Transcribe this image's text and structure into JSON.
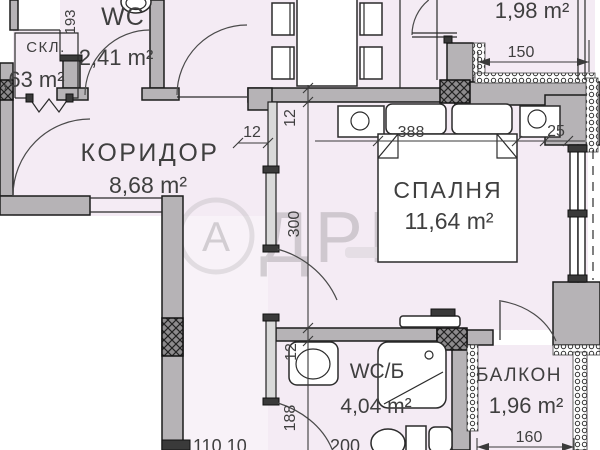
{
  "plan": {
    "rooms": {
      "storage": {
        "label": "СКЛ.",
        "area": "1,63 m²"
      },
      "wc_top": {
        "label": "WC",
        "area": "2,41 m²"
      },
      "corridor": {
        "label": "КОРИДОР",
        "area": "8,68 m²"
      },
      "bedroom": {
        "label": "СПАЛНЯ",
        "area": "11,64 m²"
      },
      "balcony_top": {
        "area": "1,98 m²"
      },
      "bathroom": {
        "label": "WC/Б",
        "area": "4,04 m²"
      },
      "balcony_bottom": {
        "label": "БАЛКОН",
        "area": "1,96 m²"
      }
    },
    "dimensions": {
      "wc_door": "193",
      "wall_thickness_h": "12",
      "wall_thickness_v": "12",
      "bedroom_depth": "300",
      "bedroom_width": "388",
      "nightstand_gap": "25",
      "balcony_top_width": "150",
      "balcony_bottom_width": "160",
      "bathroom_depth": "188",
      "bathroom_wall": "12",
      "bottom_left_chain": "110 10",
      "bottom_center_chain": "200"
    },
    "watermark": {
      "logo_letter": "А",
      "brand": "ДРЕС"
    },
    "colors": {
      "room_fill": "#f4ebf4",
      "wall_fill": "#b6b3b6",
      "line": "#1c1c1c"
    }
  }
}
